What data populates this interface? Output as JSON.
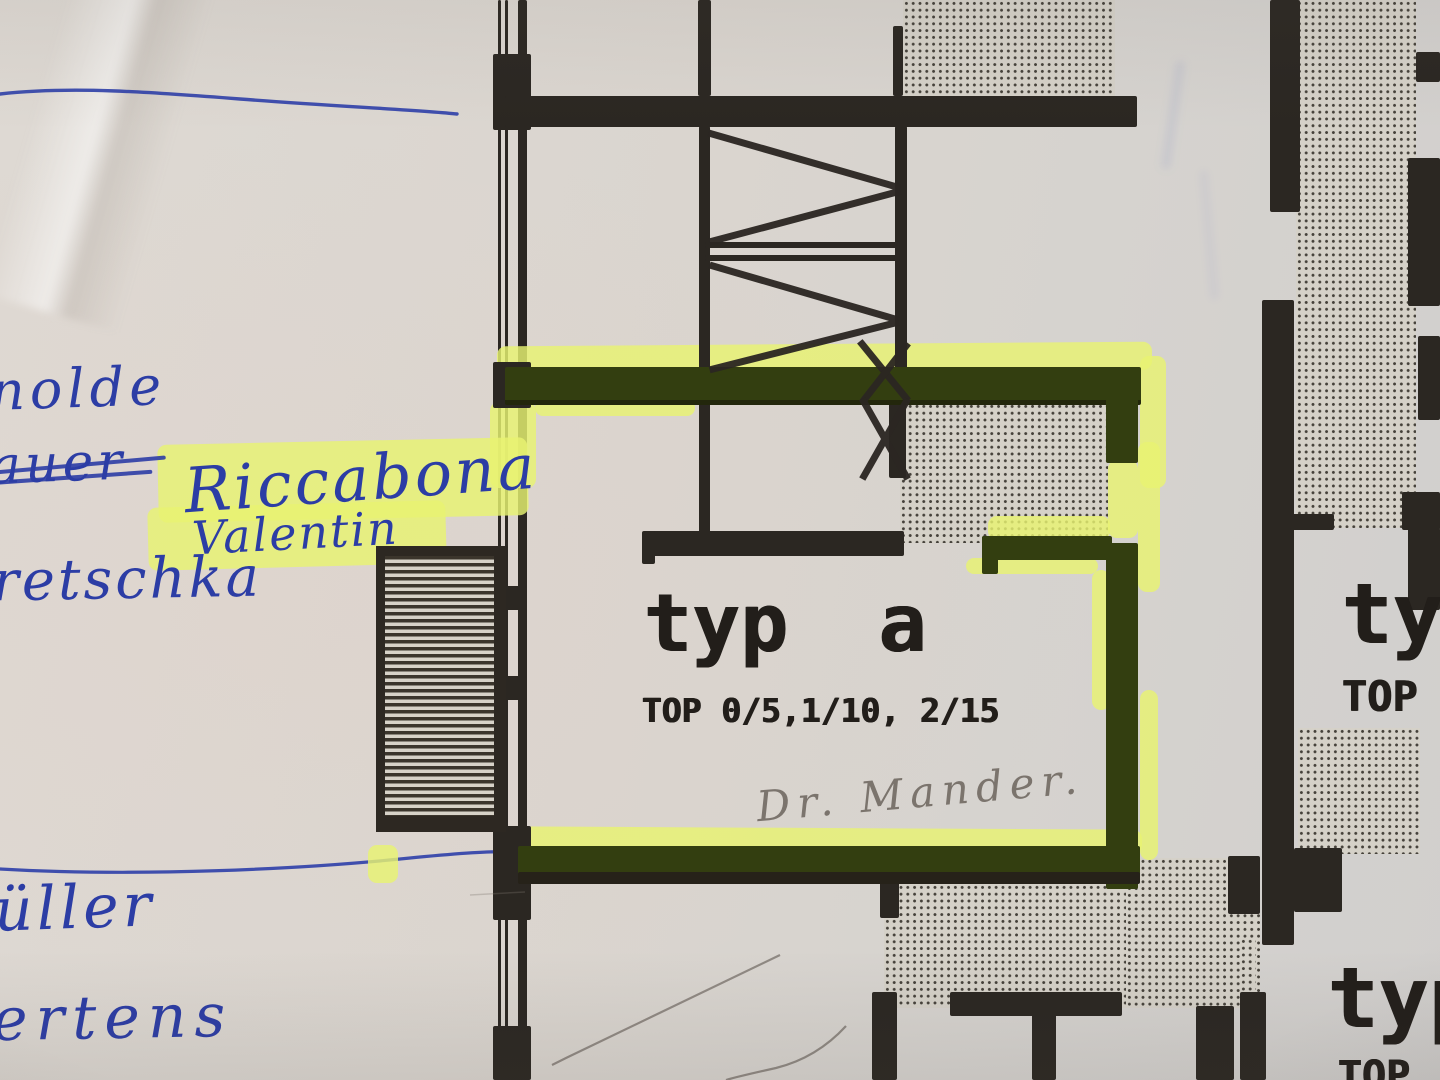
{
  "plan": {
    "unit_a": {
      "type_label": "typ a",
      "top_label": "TOP 0/5,1/10, 2/15"
    },
    "unit_right": {
      "type_label": "typ",
      "top_label": "TOP"
    },
    "unit_bottom_right": {
      "type_label": "typ",
      "top_label": "TOP"
    }
  },
  "annotations": {
    "pencil_note": "Dr. Mander.",
    "names": [
      {
        "text": "nolde",
        "style": "pen"
      },
      {
        "text": "auer",
        "style": "pen-struck-out"
      },
      {
        "text": "Riccabona",
        "style": "pen-highlighted"
      },
      {
        "text": "Valentin",
        "style": "pen-highlighted"
      },
      {
        "text": "retschka",
        "style": "pen"
      },
      {
        "text": "üller",
        "style": "pen"
      },
      {
        "text": "ertens",
        "style": "pen"
      }
    ]
  },
  "colors": {
    "paper": "#dad5ce",
    "print_black": "#2b2722",
    "ink_blue": "#2c3da5",
    "highlighter_yellow": "#e8f372",
    "highlight_over_wall_olive": "#333e10",
    "pencil_gray": "#7b746d",
    "stipple_dot": "#45413a"
  }
}
